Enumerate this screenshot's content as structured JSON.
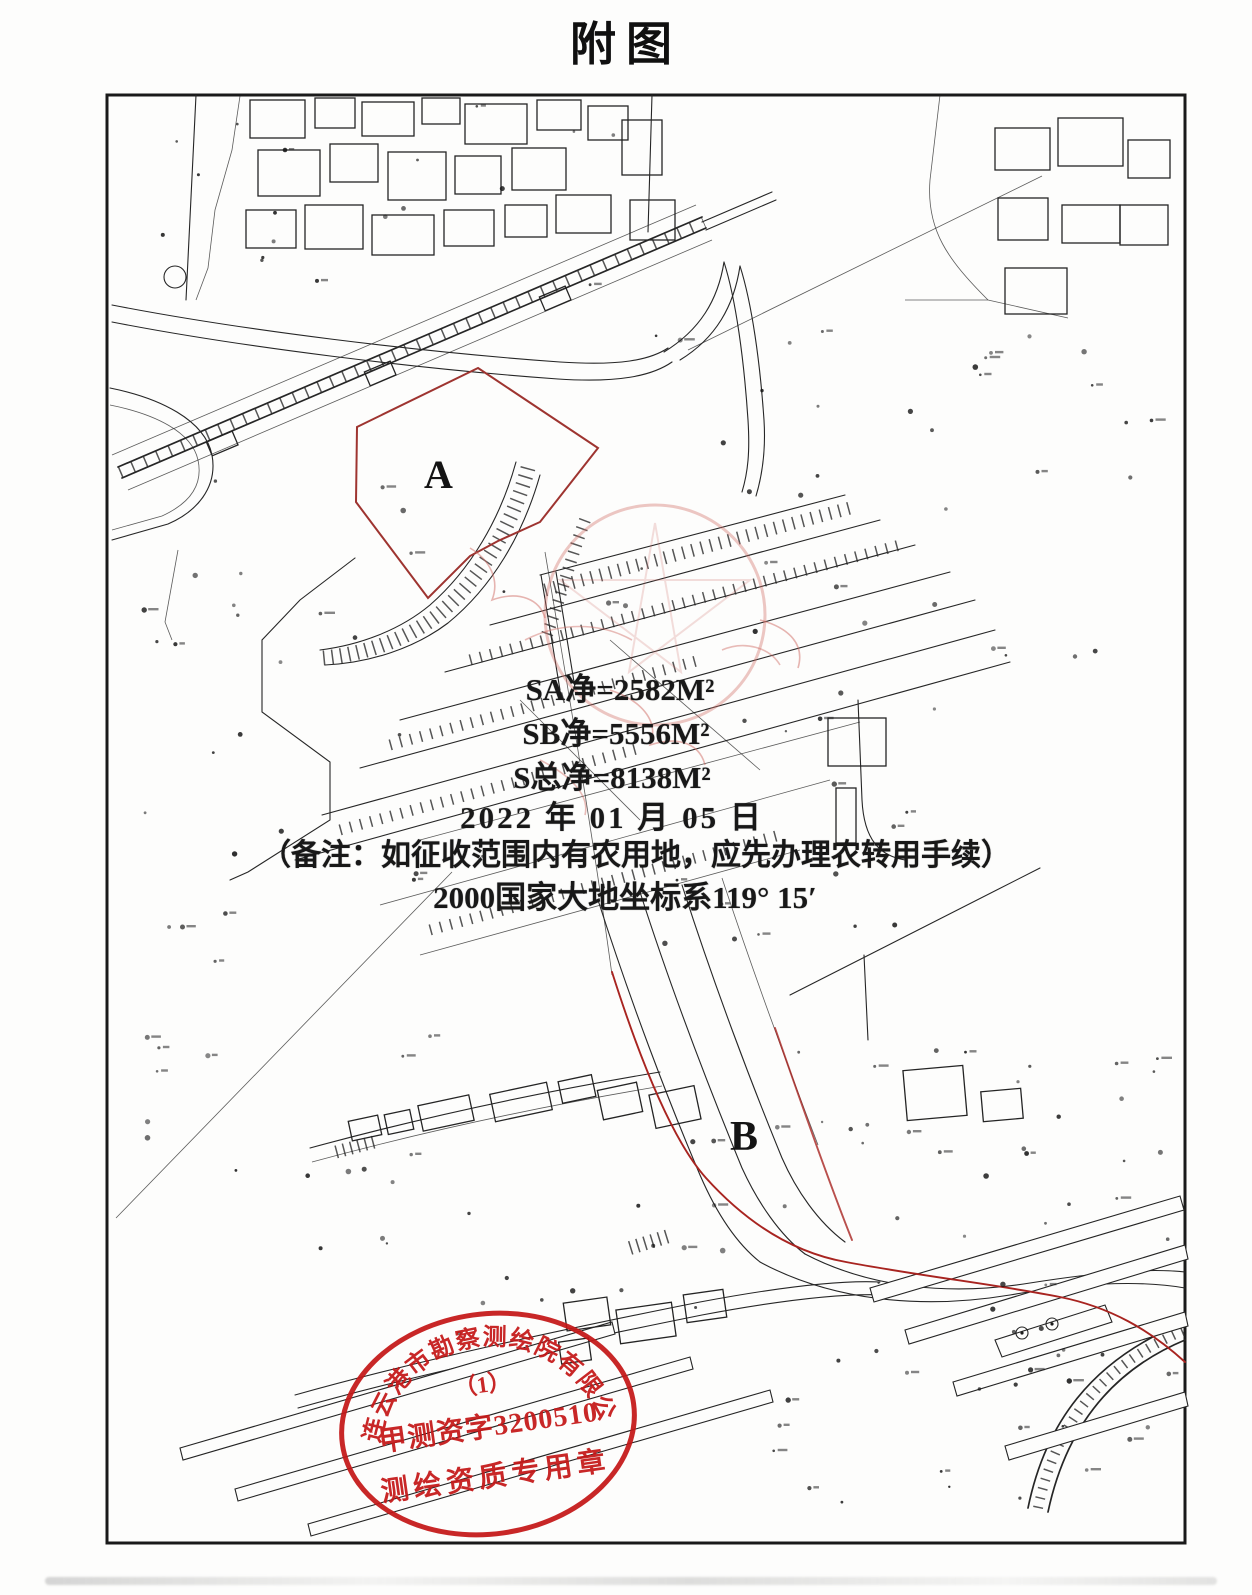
{
  "page": {
    "title": "附图"
  },
  "map": {
    "annotations": {
      "area_a": "SA净=2582M²",
      "area_b": "SB净=5556M²",
      "area_total": "S总净=8138M²",
      "date": "2022 年 01 月 05 日",
      "note": "（备注：如征收范围内有农用地，应先办理农转用手续）",
      "coordinate_system": "2000国家大地坐标系119° 15′"
    },
    "parcel_labels": {
      "a": "A",
      "b": "B"
    },
    "stamp": {
      "company": "连云港市勘察测绘院有限公司",
      "number_line": "（1）",
      "license": "甲测资字3200510",
      "seal_type": "测绘资质专用章",
      "color": "#c41717"
    },
    "colors": {
      "linework": "#262626",
      "parcel_outline": "#9e3430",
      "route_line": "#a82420",
      "seal_faint": "#cf6b63"
    }
  }
}
